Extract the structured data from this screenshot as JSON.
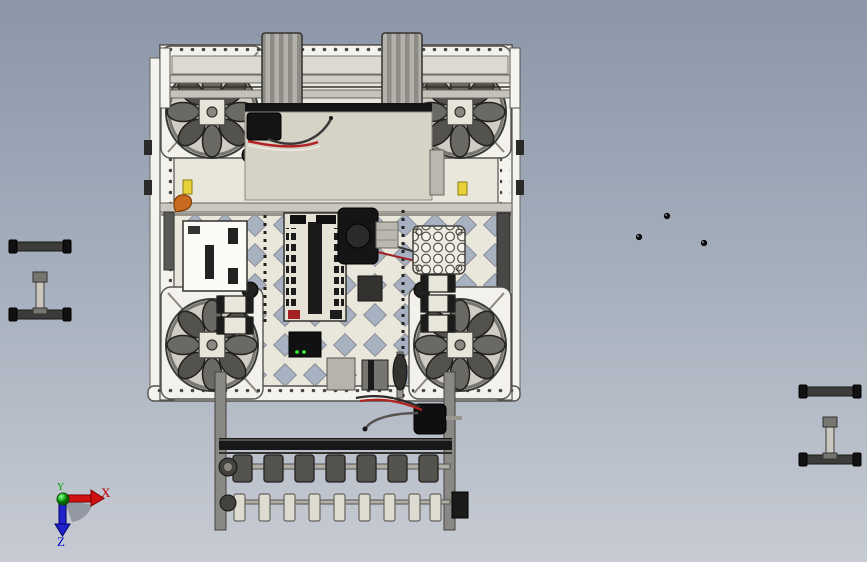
{
  "viewport": {
    "kind": "cad-3d-viewport",
    "background_top": "#8B96A8",
    "background_bottom": "#C7CBD3"
  },
  "triad": {
    "labels": {
      "x": "X",
      "y": "Y",
      "z": "Z"
    },
    "colors": {
      "x": "#C00000",
      "y": "#00A000",
      "z": "#0000C8"
    }
  },
  "assembly": {
    "parts": [
      {
        "name": "drive-chassis-frame",
        "color": "#F2F1EB"
      },
      {
        "name": "mecanum-wheel-front-left",
        "color": "#54524D"
      },
      {
        "name": "mecanum-wheel-front-right",
        "color": "#54524D"
      },
      {
        "name": "mecanum-wheel-rear-left",
        "color": "#54524D"
      },
      {
        "name": "mecanum-wheel-rear-right",
        "color": "#54524D"
      },
      {
        "name": "top-intake-wheel-stacks",
        "color": "#8F8D88"
      },
      {
        "name": "battery-cover-plate",
        "color": "#D6D3C6"
      },
      {
        "name": "controller-board",
        "color": "#FBFAF7"
      },
      {
        "name": "power-distribution-panel",
        "color": "#E6E3D6"
      },
      {
        "name": "center-motor",
        "color": "#151515",
        "wire_colors": [
          "#B22222",
          "#3A3A3A"
        ]
      },
      {
        "name": "hex-pattern-plate",
        "color": "#EDEBE0"
      },
      {
        "name": "motor-controller-stack",
        "color": "#E8E6DA"
      },
      {
        "name": "front-roller-intake",
        "roller_colors": [
          "#55534E",
          "#DEDBD0"
        ]
      },
      {
        "name": "intake-motor",
        "color": "#0F0F0F"
      },
      {
        "name": "loose-shaft-assembly-left",
        "color": "#3C3C3A"
      },
      {
        "name": "loose-shaft-assembly-right",
        "color": "#3C3C3A"
      },
      {
        "name": "loose-fasteners",
        "count": 3,
        "color": "#111111"
      },
      {
        "name": "orange-hook",
        "color": "#C96A1E"
      }
    ]
  }
}
